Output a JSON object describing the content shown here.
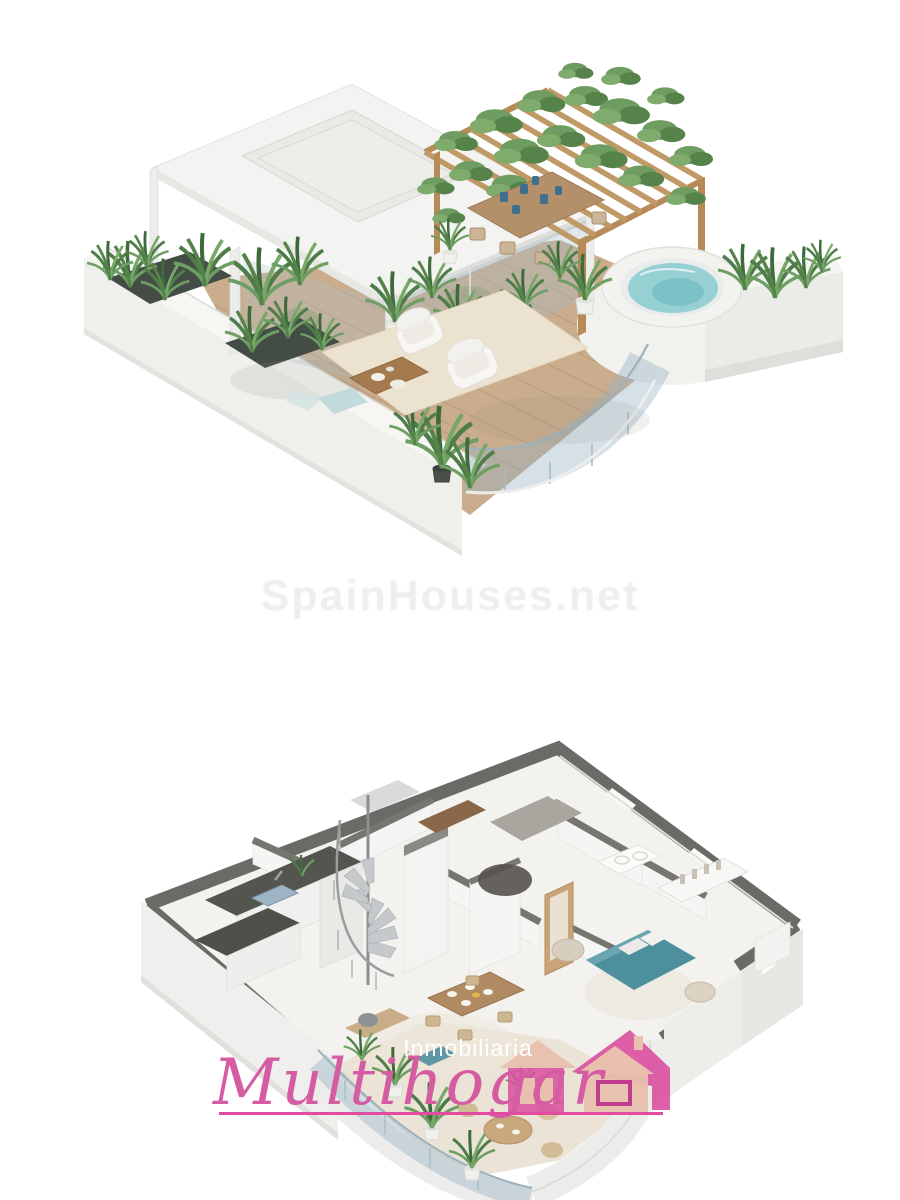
{
  "canvas": {
    "background": "#ffffff",
    "width": 900,
    "height": 1200
  },
  "watermark": {
    "text": "SpainHouses.net"
  },
  "renders": {
    "top": {
      "title": "rooftop-terrace-3d-render",
      "features": [
        "white canopy with skylight",
        "wood pergola covered in vines",
        "outdoor dining table with blue tableware",
        "round jacuzzi",
        "curved glass balustrade",
        "two cream lounge chairs",
        "wood slat coffee table with plates",
        "potted green plants",
        "wood deck",
        "white parapet planters"
      ],
      "colors": {
        "wall_white": "#efefec",
        "deck_wood": "#c9ad8d",
        "pergola_wood": "#c09a66",
        "plant_green": "#4e7d49",
        "jacuzzi_water": "#96d0d3",
        "rug_beige": "#ece2d0"
      }
    },
    "bottom": {
      "title": "apartment-floor-plan-3d-render",
      "features": [
        "kitchen with dark counters and sink",
        "spiral staircase",
        "bedroom with gray bed and round rug",
        "bathroom with white basin",
        "bedroom with teal bed",
        "open wardrobe with clothes",
        "dining table with place settings",
        "curved glass terrace with plants",
        "round terrace table"
      ],
      "colors": {
        "wall_top_gray": "#6b6a67",
        "wall_face": "#efefec",
        "floor": "#f3f2ee",
        "counter_dark": "#55554f",
        "bed_teal": "#4e8f9e",
        "bed_gray": "#a9a59f",
        "table_wood": "#b08a62"
      }
    }
  },
  "logo": {
    "tagline": "Inmobiliaria",
    "brand": "Multihogar",
    "colors": {
      "brand_pink": "#d55ca3",
      "underline_pink": "#e24ba0",
      "house_pink": "#d94f9f",
      "house_salmon": "#e9bfae",
      "tagline_white": "#ffffff"
    }
  }
}
